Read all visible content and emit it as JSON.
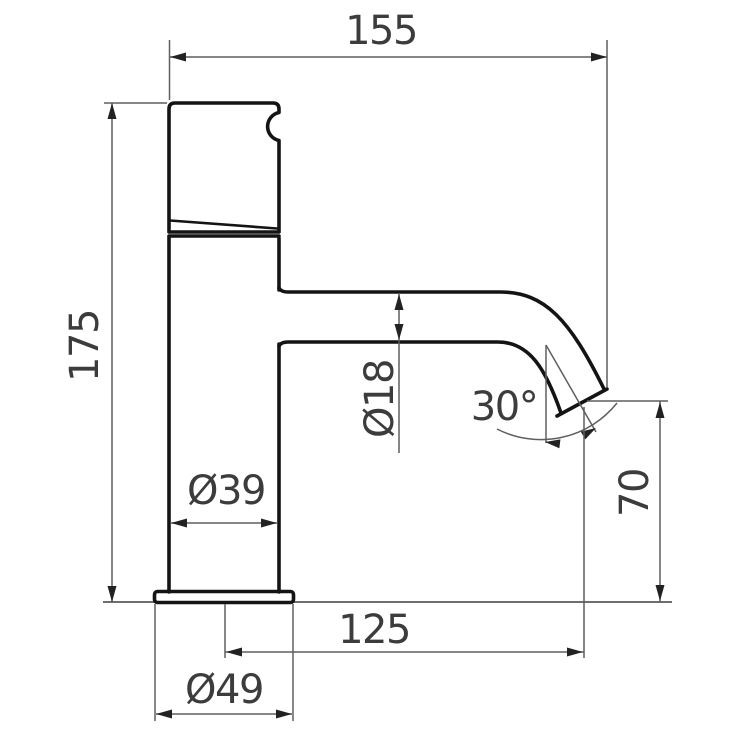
{
  "drawing": {
    "dimensions": {
      "overall_width": "155",
      "overall_height": "175",
      "spout_diameter": "Ø18",
      "spout_angle": "30°",
      "outlet_height": "70",
      "body_diameter": "Ø39",
      "spout_reach": "125",
      "base_diameter": "Ø49"
    },
    "colors": {
      "outline": "#141414",
      "dimension_lines": "#5f5f5f",
      "text": "#3c3c3c",
      "background": "#ffffff"
    }
  }
}
